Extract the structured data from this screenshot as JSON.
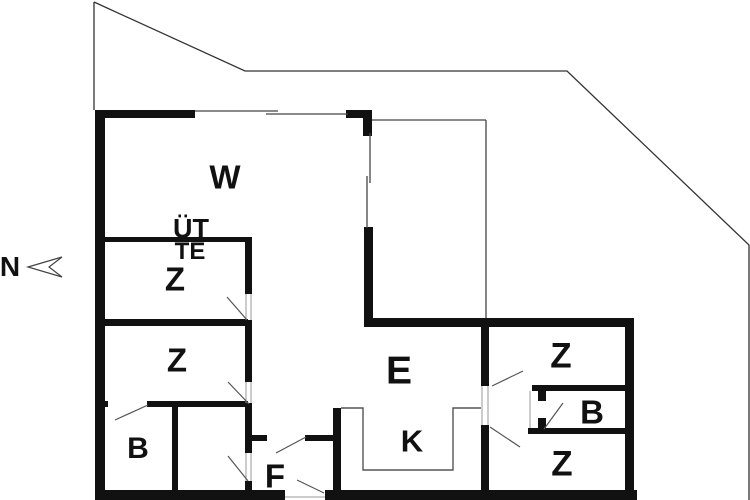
{
  "plan": {
    "compass": {
      "label": "N"
    },
    "rooms": [
      {
        "id": "w",
        "label": "W"
      },
      {
        "id": "uet",
        "label": "ÜT"
      },
      {
        "id": "te",
        "label": "TE"
      },
      {
        "id": "z1",
        "label": "Z"
      },
      {
        "id": "z2",
        "label": "Z"
      },
      {
        "id": "b1",
        "label": "B"
      },
      {
        "id": "f",
        "label": "F"
      },
      {
        "id": "e",
        "label": "E"
      },
      {
        "id": "k",
        "label": "K"
      },
      {
        "id": "z3",
        "label": "Z"
      },
      {
        "id": "b2",
        "label": "B"
      },
      {
        "id": "z4",
        "label": "Z"
      }
    ],
    "colors": {
      "wall": "#111111",
      "thin_line": "#555555",
      "boundary_line": "#333333",
      "background": "#ffffff",
      "text": "#111111"
    }
  }
}
